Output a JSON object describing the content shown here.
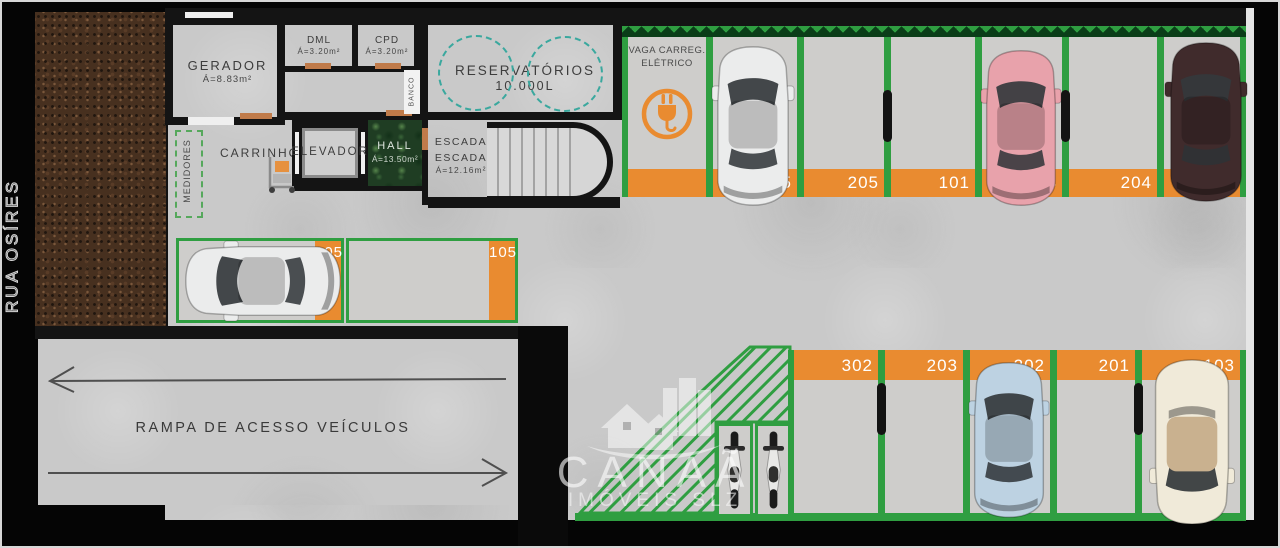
{
  "street": {
    "name": "RUA OSÍRES"
  },
  "rooms": {
    "gerador": {
      "name": "GERADOR",
      "area": "Á=8.83m²"
    },
    "dml": {
      "name": "DML",
      "area": "Á=3.20m²"
    },
    "cpd": {
      "name": "CPD",
      "area": "Á=3.20m²"
    },
    "banco": {
      "name": "BANCO"
    },
    "reservatorios": {
      "name": "RESERVATÓRIOS",
      "capacity": "10.000L"
    },
    "medidores": {
      "name": "MEDIDORES"
    },
    "carrinhos": {
      "name": "CARRINHOS"
    },
    "elevador": {
      "name": "ELEVADOR"
    },
    "hall": {
      "name": "HALL",
      "area": "Á=13.50m²"
    },
    "escada": {
      "label_upper": "ESCADA",
      "name": "ESCADA",
      "area": "Á=12.16m²"
    }
  },
  "ev_spot": {
    "line1": "VAGA CARREG.",
    "line2": "ELÉTRICO"
  },
  "ramp": {
    "label": "RAMPA DE ACESSO VEÍCULOS"
  },
  "parking": {
    "top_row": {
      "spots": [
        {
          "number": "505",
          "vehicle": "white car"
        },
        {
          "number": "205",
          "vehicle": null
        },
        {
          "number": "101",
          "vehicle": null
        },
        {
          "number": "104",
          "vehicle": "pink car"
        },
        {
          "number": "204",
          "vehicle": null
        },
        {
          "number": "102",
          "vehicle": "dark brown car"
        }
      ]
    },
    "bottom_row": {
      "spots": [
        {
          "number": "302",
          "vehicle": null
        },
        {
          "number": "203",
          "vehicle": null
        },
        {
          "number": "202",
          "vehicle": "light blue car"
        },
        {
          "number": "201",
          "vehicle": null
        },
        {
          "number": "103",
          "vehicle": "cream car"
        }
      ]
    },
    "side_spots": [
      {
        "number": "105",
        "vehicle": "white car"
      },
      {
        "number": "105",
        "vehicle": null
      }
    ],
    "moto_spots": [
      {
        "vehicle": "motorcycle"
      },
      {
        "vehicle": "motorcycle"
      }
    ]
  },
  "watermark": {
    "brand": "CANAÃ",
    "sub": "IMÓVEIS SLZ"
  },
  "colors": {
    "divider_green": "#2f9e41",
    "stripe_orange": "#e98b30",
    "reservoir_teal": "#3aa89e",
    "car_white": "#ebecec",
    "car_pink": "#e8a2ab",
    "car_brown": "#402b2c",
    "car_blue": "#bdd2e2",
    "car_cream": "#f0ead9",
    "moto_white": "#e9e9e7"
  }
}
